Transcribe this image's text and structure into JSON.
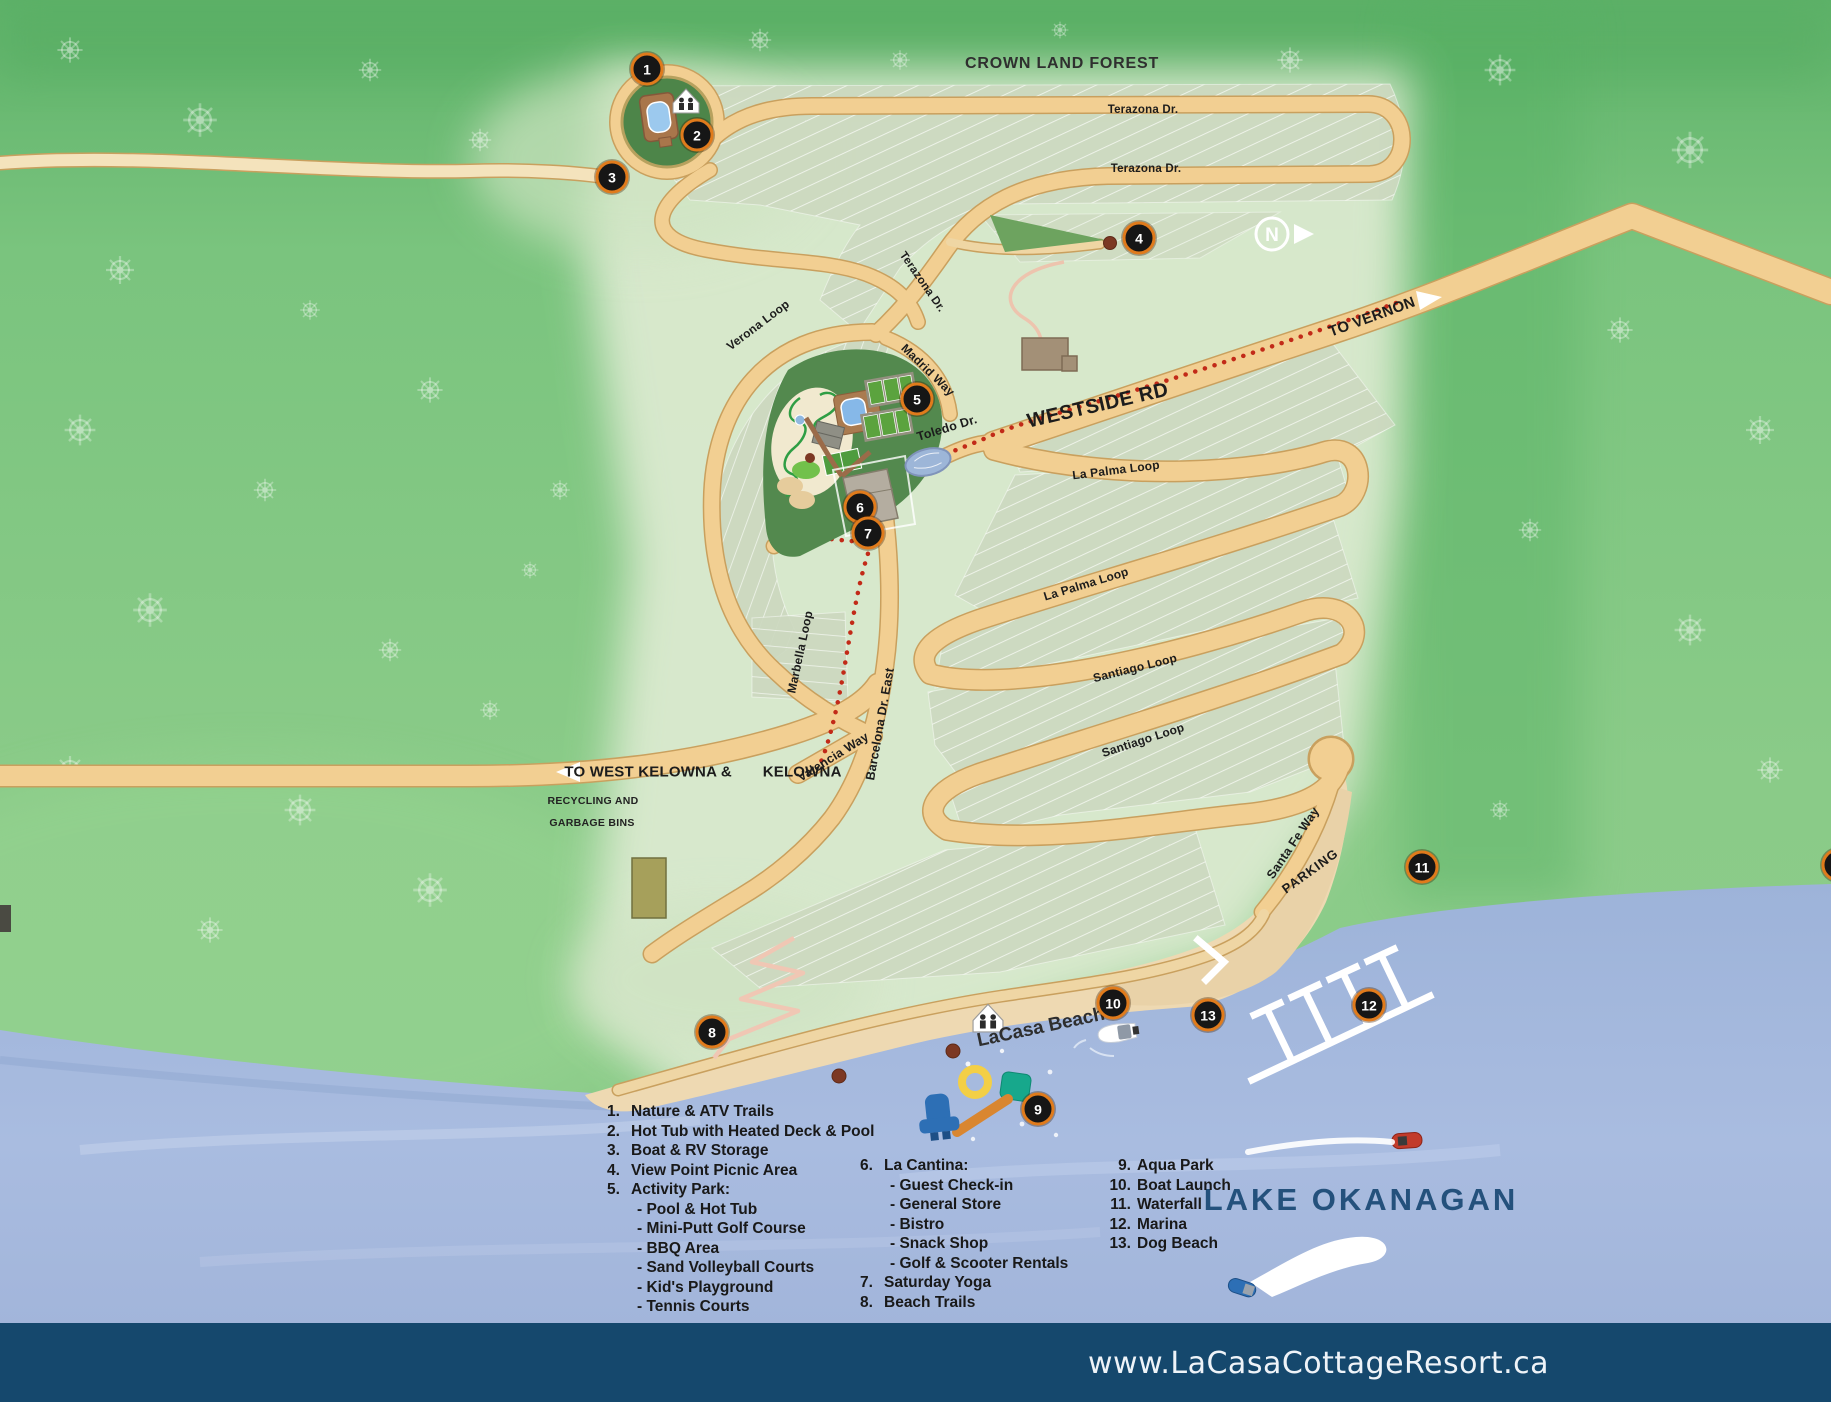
{
  "title_labels": {
    "crown_land_forest": "CROWN LAND FOREST",
    "lake_okanagan": "LAKE OKANAGAN",
    "lacasa_beach": "LaCasa Beach",
    "recycling_1": "RECYCLING AND",
    "recycling_2": "GARBAGE BINS",
    "parking": "PARKING"
  },
  "roads": {
    "terazona_1": "Terazona Dr.",
    "terazona_2": "Terazona Dr.",
    "terazona_3": "Terazona Dr.",
    "verona": "Verona Loop",
    "madrid": "Madrid Way",
    "toledo": "Toledo Dr.",
    "westside": "WESTSIDE RD",
    "to_vernon": "TO VERNON",
    "la_palma_1": "La Palma Loop",
    "la_palma_2": "La Palma Loop",
    "santiago_1": "Santiago Loop",
    "santiago_2": "Santiago Loop",
    "marbella": "Marbella Loop",
    "valencia": "Valencia Way",
    "barcelona": "Barcelona Dr. East",
    "santa_fe": "Santa Fe Way",
    "to_kelowna_a": "TO WEST KELOWNA &",
    "to_kelowna_b": "KELOWNA"
  },
  "compass": {
    "letter": "N"
  },
  "markers": [
    "1",
    "2",
    "3",
    "4",
    "5",
    "6",
    "7",
    "8",
    "9",
    "10",
    "11",
    "12",
    "13",
    "1"
  ],
  "legend": {
    "c1": [
      {
        "n": "1.",
        "t": "Nature & ATV Trails"
      },
      {
        "n": "2.",
        "t": "Hot Tub with Heated Deck & Pool"
      },
      {
        "n": "3.",
        "t": "Boat & RV Storage"
      },
      {
        "n": "4.",
        "t": "View Point Picnic Area"
      },
      {
        "n": "5.",
        "t": "Activity Park:",
        "subs": [
          "- Pool & Hot Tub",
          "- Mini-Putt Golf Course",
          "- BBQ Area",
          "- Sand Volleyball Courts",
          "- Kid's Playground",
          "- Tennis Courts"
        ]
      }
    ],
    "c2": [
      {
        "n": "6.",
        "t": "La Cantina:",
        "subs": [
          "- Guest Check-in",
          "- General Store",
          "- Bistro",
          "- Snack Shop",
          "- Golf & Scooter Rentals"
        ]
      },
      {
        "n": "7.",
        "t": "Saturday Yoga"
      },
      {
        "n": "8.",
        "t": "Beach Trails"
      }
    ],
    "c3": [
      {
        "n": "9.",
        "t": "Aqua Park"
      },
      {
        "n": "10.",
        "t": "Boat Launch"
      },
      {
        "n": "11.",
        "t": "Waterfall"
      },
      {
        "n": "12.",
        "t": "Marina"
      },
      {
        "n": "13.",
        "t": "Dog Beach"
      }
    ]
  },
  "footer": {
    "url": "www.LaCasaCottageResort.ca"
  },
  "colors": {
    "road": "#f2cf92",
    "road_casing": "#c9a05e",
    "water": "#a6badf",
    "sand": "#eed9b2",
    "marker_ring": "#e07b1c",
    "footer_bar": "#15486d",
    "trail_red": "#c22a18",
    "lake_text": "#24517c",
    "lots": "#cdd9c0",
    "park_green": "#53894e"
  }
}
